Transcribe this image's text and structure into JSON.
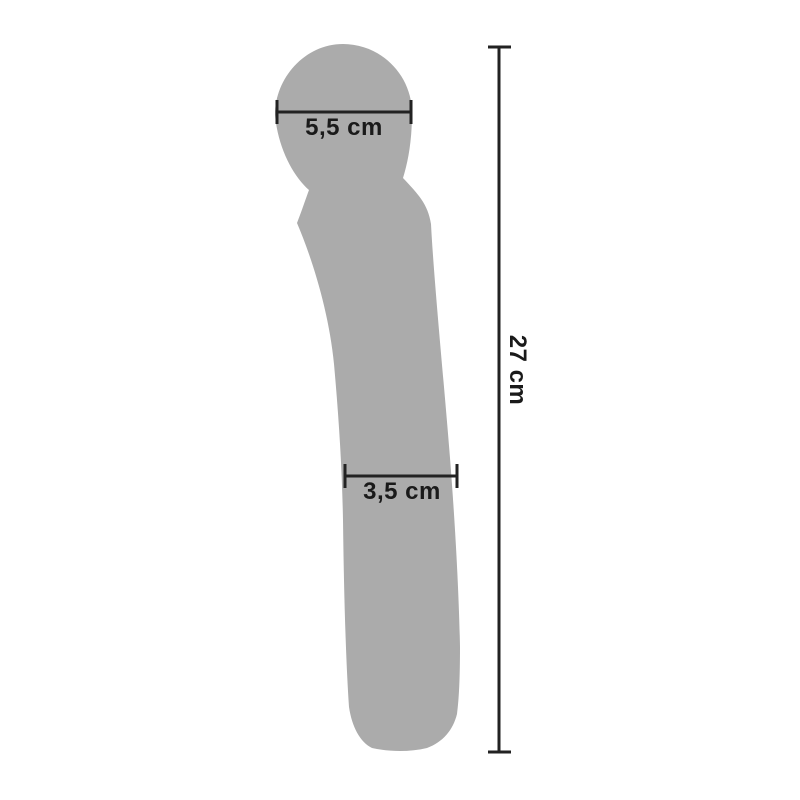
{
  "diagram": {
    "object_name": "wand-massager-silhouette",
    "background_color": "#ffffff",
    "silhouette_color": "#ababab",
    "line_color": "#222222",
    "label_color": "#1a1a1a",
    "measurements": {
      "head_width": {
        "label": "5,5 cm",
        "value_cm": 5.5,
        "orientation": "horizontal"
      },
      "shaft_width": {
        "label": "3,5 cm",
        "value_cm": 3.5,
        "orientation": "horizontal"
      },
      "total_length": {
        "label": "27 cm",
        "value_cm": 27,
        "orientation": "vertical"
      }
    }
  }
}
